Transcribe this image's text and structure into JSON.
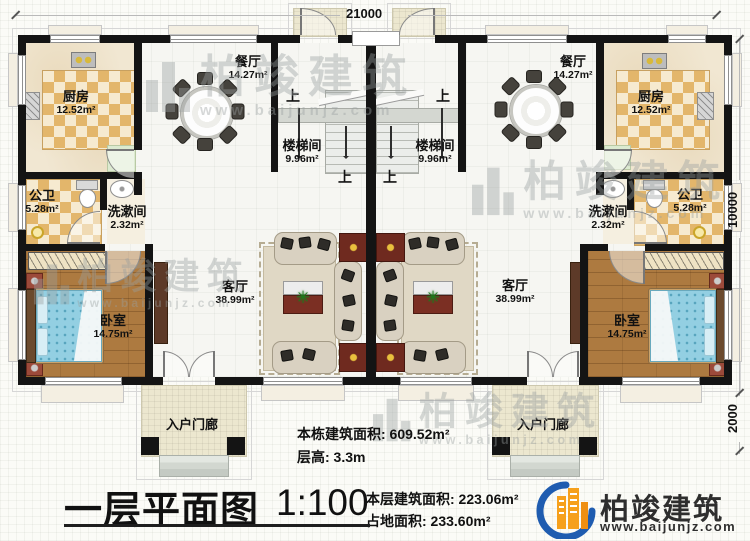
{
  "dimensions": {
    "top": "21000",
    "side_main": "10000",
    "side_porch": "2000"
  },
  "rooms": {
    "dining": {
      "name": "餐厅",
      "area": "14.27m²"
    },
    "kitchen": {
      "name": "厨房",
      "area": "12.52m²"
    },
    "stairwell": {
      "name": "楼梯间",
      "area": "9.96m²"
    },
    "bathroom": {
      "name": "公卫",
      "area": "5.28m²"
    },
    "washroom": {
      "name": "洗漱间",
      "area": "2.32m²"
    },
    "living": {
      "name": "客厅",
      "area": "38.99m²"
    },
    "bedroom": {
      "name": "卧室",
      "area": "14.75m²"
    },
    "porch": {
      "name": "入户门廊"
    }
  },
  "stairs": {
    "up": "上"
  },
  "stats": {
    "building_area": "本栋建筑面积: 609.52m²",
    "floor_height": "层高: 3.3m",
    "level_area": "本层建筑面积: 223.06m²",
    "footprint": "占地面积: 233.60m²"
  },
  "title": {
    "text": "一层平面图",
    "scale": "1:100"
  },
  "brand": {
    "name": "柏竣建筑",
    "url": "www.baijunjz.com"
  },
  "watermark": {
    "text": "柏竣建筑",
    "url": "www.baijunjz.com"
  },
  "icons": {
    "plant": "✳"
  },
  "colors": {
    "wall": "#141414",
    "accent_red": "#7b2f23",
    "wood": "#ad7a40",
    "bed_blue": "#93cfe2",
    "checker_tan": "#e3b66b",
    "logo_blue": "#1f5cb0",
    "logo_orange": "#f6a01c"
  }
}
